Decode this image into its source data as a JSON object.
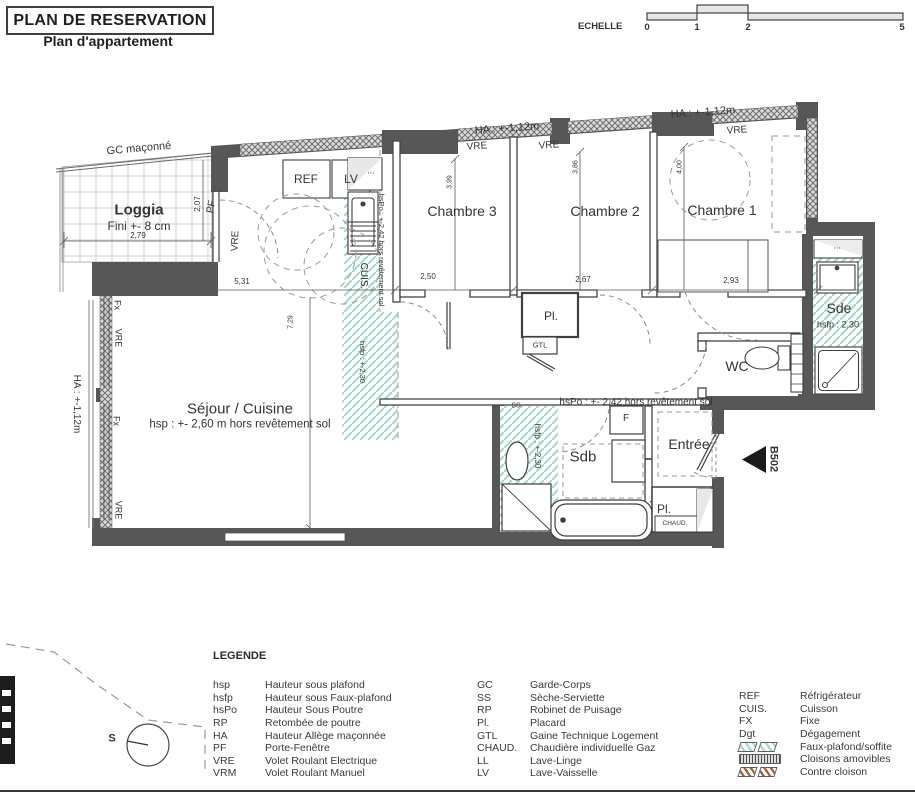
{
  "header": {
    "title": "PLAN DE RESERVATION",
    "subtitle": "Plan d'appartement"
  },
  "scale": {
    "label": "ECHELLE",
    "ticks": [
      "0",
      "1",
      "2",
      "5"
    ]
  },
  "plan": {
    "unit": "B502",
    "compass": "S",
    "corridor_note": "hsPo : +- 2,42 hors revêtement sol",
    "outside": {
      "gc": "GC maçonné",
      "ha1": "HA : +-1,12m",
      "ha2": "HA : +-1,12m",
      "ha_left": "HA : +-1,12m"
    },
    "loggia": {
      "name": "Loggia",
      "fini": "Fini +- 8 cm",
      "pf": "PF",
      "vre": "VRE"
    },
    "windows": {
      "vre_ch3": "VRE",
      "vre_ch2": "VRE",
      "vre_ch1": "VRE",
      "fx1": "Fx",
      "vre1": "VRE",
      "fx2": "Fx",
      "vre2": "VRE"
    },
    "kitchen": {
      "ref": "REF",
      "lv": "LV",
      "dots": "...",
      "cuis": "CUIS.",
      "hspo": "hsPo : +-2,42 hors revêtement sol",
      "hsfp": "hsfp : +-2,30"
    },
    "rooms": {
      "ch1": "Chambre 1",
      "ch2": "Chambre 2",
      "ch3": "Chambre 3",
      "sejour": {
        "name": "Séjour / Cuisine",
        "note": "hsp : +- 2,60 m hors revêtement sol"
      },
      "sde": {
        "name": "Sde",
        "note": "hsfp : 2,30",
        "dots": "..."
      },
      "wc": "WC",
      "sdb": {
        "name": "Sdb",
        "note": "hsfp : +-2,30",
        "ss": "SS",
        "f": "F"
      },
      "entree": "Entrée",
      "pl1": "Pl.",
      "gtl": "GTL",
      "pl2": "Pl.",
      "chaud": "CHAUD."
    },
    "dims": {
      "d279": "2,79",
      "d207": "2,07",
      "d399": "3,99",
      "d386": "3,86",
      "d400": "4,00",
      "d250": "2,50",
      "d267": "2,67",
      "d293": "2,93",
      "d531": "5,31",
      "d729": "7,29"
    }
  },
  "legend": {
    "heading": "LEGENDE",
    "col1": [
      {
        "a": "hsp",
        "l": "Hauteur sous plafond"
      },
      {
        "a": "hsfp",
        "l": "Hauteur sous Faux-plafond"
      },
      {
        "a": "hsPo",
        "l": "Hauteur Sous Poutre"
      },
      {
        "a": "RP",
        "l": "Retombée de poutre"
      },
      {
        "a": "HA",
        "l": "Hauteur Allège maçonnée"
      },
      {
        "a": "PF",
        "l": "Porte-Fenêtre"
      },
      {
        "a": "VRE",
        "l": "Volet Roulant Electrique"
      },
      {
        "a": "VRM",
        "l": "Volet Roulant Manuel"
      }
    ],
    "col2": [
      {
        "a": "GC",
        "l": "Garde-Corps"
      },
      {
        "a": "SS",
        "l": "Sèche-Serviette"
      },
      {
        "a": "RP",
        "l": "Robinet de Puisage"
      },
      {
        "a": "Pl.",
        "l": "Placard"
      },
      {
        "a": "GTL",
        "l": "Gaine Technique Logement"
      },
      {
        "a": "CHAUD.",
        "l": "Chaudière individuelle Gaz"
      },
      {
        "a": "LL",
        "l": "Lave-Linge"
      },
      {
        "a": "LV",
        "l": "Lave-Vaisselle"
      }
    ],
    "col3_text": [
      {
        "a": "REF",
        "l": "Réfrigérateur"
      },
      {
        "a": "CUIS.",
        "l": "Cuisson"
      },
      {
        "a": "FX",
        "l": "Fixe"
      },
      {
        "a": "Dgt",
        "l": "Dégagement"
      }
    ],
    "col3_swatches": [
      {
        "l": "Faux-plafond/soffite"
      },
      {
        "l": "Cloisons amovibles"
      },
      {
        "l": "Contre cloison"
      }
    ]
  },
  "palette": {
    "wall_gray": "#575757",
    "soffit_green": "#a9d9c6",
    "contre_cloison_red": "#a4613f"
  }
}
